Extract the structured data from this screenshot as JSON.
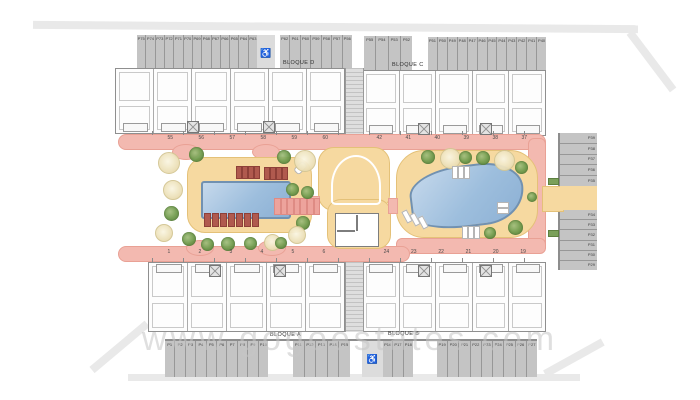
{
  "watermark": "www.gogoestates.com",
  "blocks": {
    "top_left": "BLOQUE D",
    "top_right": "BLOQUE C",
    "bottom_left": "BLOQUE A",
    "bottom_right": "BLOQUE B"
  },
  "unit_numbers": {
    "top_left": [
      "55",
      "56",
      "57",
      "58",
      "59",
      "60"
    ],
    "top_right": [
      "42",
      "41",
      "40",
      "39",
      "38",
      "37"
    ],
    "bottom_left": [
      "1",
      "2",
      "3",
      "4",
      "5",
      "6"
    ],
    "bottom_right": [
      "24",
      "23",
      "22",
      "21",
      "20",
      "19"
    ]
  },
  "parking": {
    "handicap_icon": "♿",
    "groups": {
      "top1": [
        "P75",
        "P74",
        "P73",
        "P72",
        "P71",
        "P70",
        "P69",
        "P68",
        "P67",
        "P66",
        "P65",
        "P64",
        "P63"
      ],
      "top2": [
        "P62",
        "P61",
        "P60",
        "P59",
        "P58",
        "P57",
        "P56"
      ],
      "top3": [
        "P55",
        "P54",
        "P53",
        "P52"
      ],
      "top4": [
        "P51",
        "P50",
        "P49",
        "P48",
        "P47",
        "P46",
        "P45",
        "P44",
        "P43",
        "P42",
        "P41",
        "P40"
      ],
      "rightA": [
        "P39",
        "P38",
        "P37",
        "P36",
        "P35"
      ],
      "rightB": [
        "P34",
        "P33",
        "P32",
        "P31",
        "P30",
        "P29"
      ],
      "bottom1": [
        "P1",
        "P2",
        "P3",
        "P4",
        "P5",
        "P6",
        "P7",
        "P8",
        "P9",
        "P10"
      ],
      "bottom2": [
        "P11",
        "P12",
        "P13",
        "P14",
        "P15"
      ],
      "bottom3": [
        "P16",
        "P17",
        "P18"
      ],
      "bottom4": [
        "P19",
        "P20",
        "P21",
        "P22",
        "P23",
        "P24",
        "P25",
        "P26",
        "P27"
      ]
    }
  },
  "colors": {
    "walkway_pink": "#f3b9b0",
    "deck_tan": "#f6d9a0",
    "pool_blue": "#9dbedd",
    "pool_edge": "#7191b1",
    "parking_gray": "#c4c4c4",
    "tree_green": "#719c4e",
    "tree_cream": "#ecdfb6",
    "building_wall": "#8f8f8f",
    "boundary_gray": "#e9e9e9",
    "watermark_gray": "#c6c6c6"
  }
}
